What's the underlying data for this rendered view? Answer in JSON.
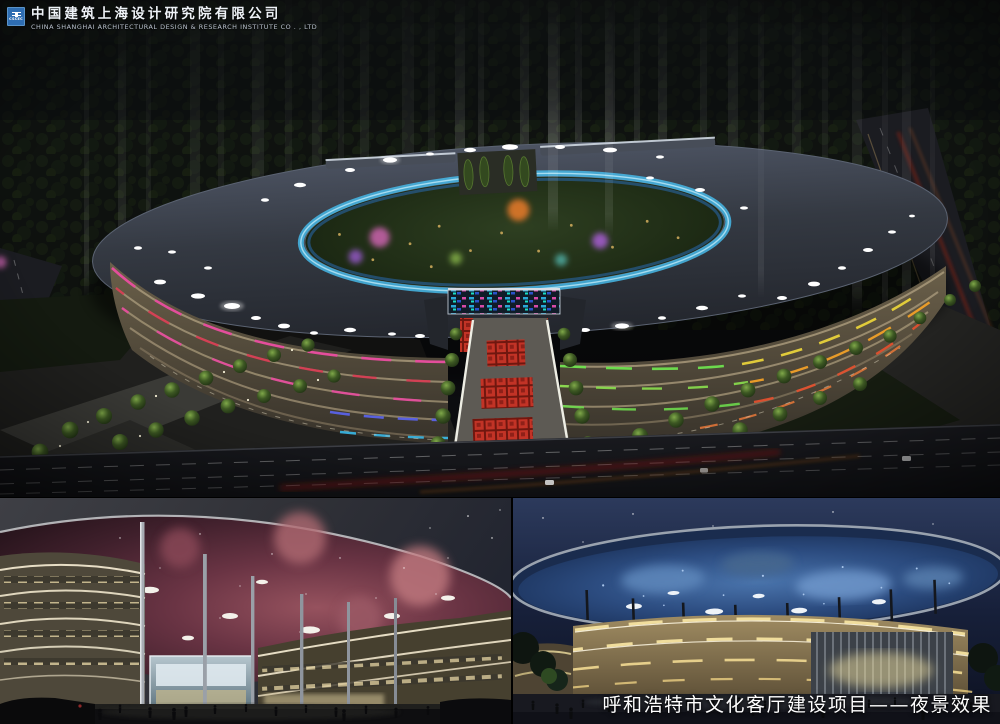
{
  "header": {
    "logo_text": "CSCEC",
    "company_cn": "中国建筑上海设计研究院有限公司",
    "company_en": "CHINA SHANGHAI ARCHITECTURAL DESIGN & RESEARCH INSTITUTE CO . , LTD"
  },
  "caption": {
    "text": "呼和浩特市文化客厅建设项目——夜景效果"
  },
  "colors": {
    "logo_blue": "#2e6db2",
    "neon_magenta": "#e84b9e",
    "neon_red": "#d83a52",
    "neon_blue": "#5a62e8",
    "neon_cyan": "#37b8e8",
    "neon_green": "#6ee24e",
    "neon_orange": "#f08030",
    "inner_ring_glass": "#46b9e8",
    "roof_gray": "#3b4048",
    "nebula_pink": "#8c5260",
    "galaxy_blue": "#4a74ac",
    "gold_band": "#f2e2a8",
    "plaza_red": "#c23326"
  }
}
